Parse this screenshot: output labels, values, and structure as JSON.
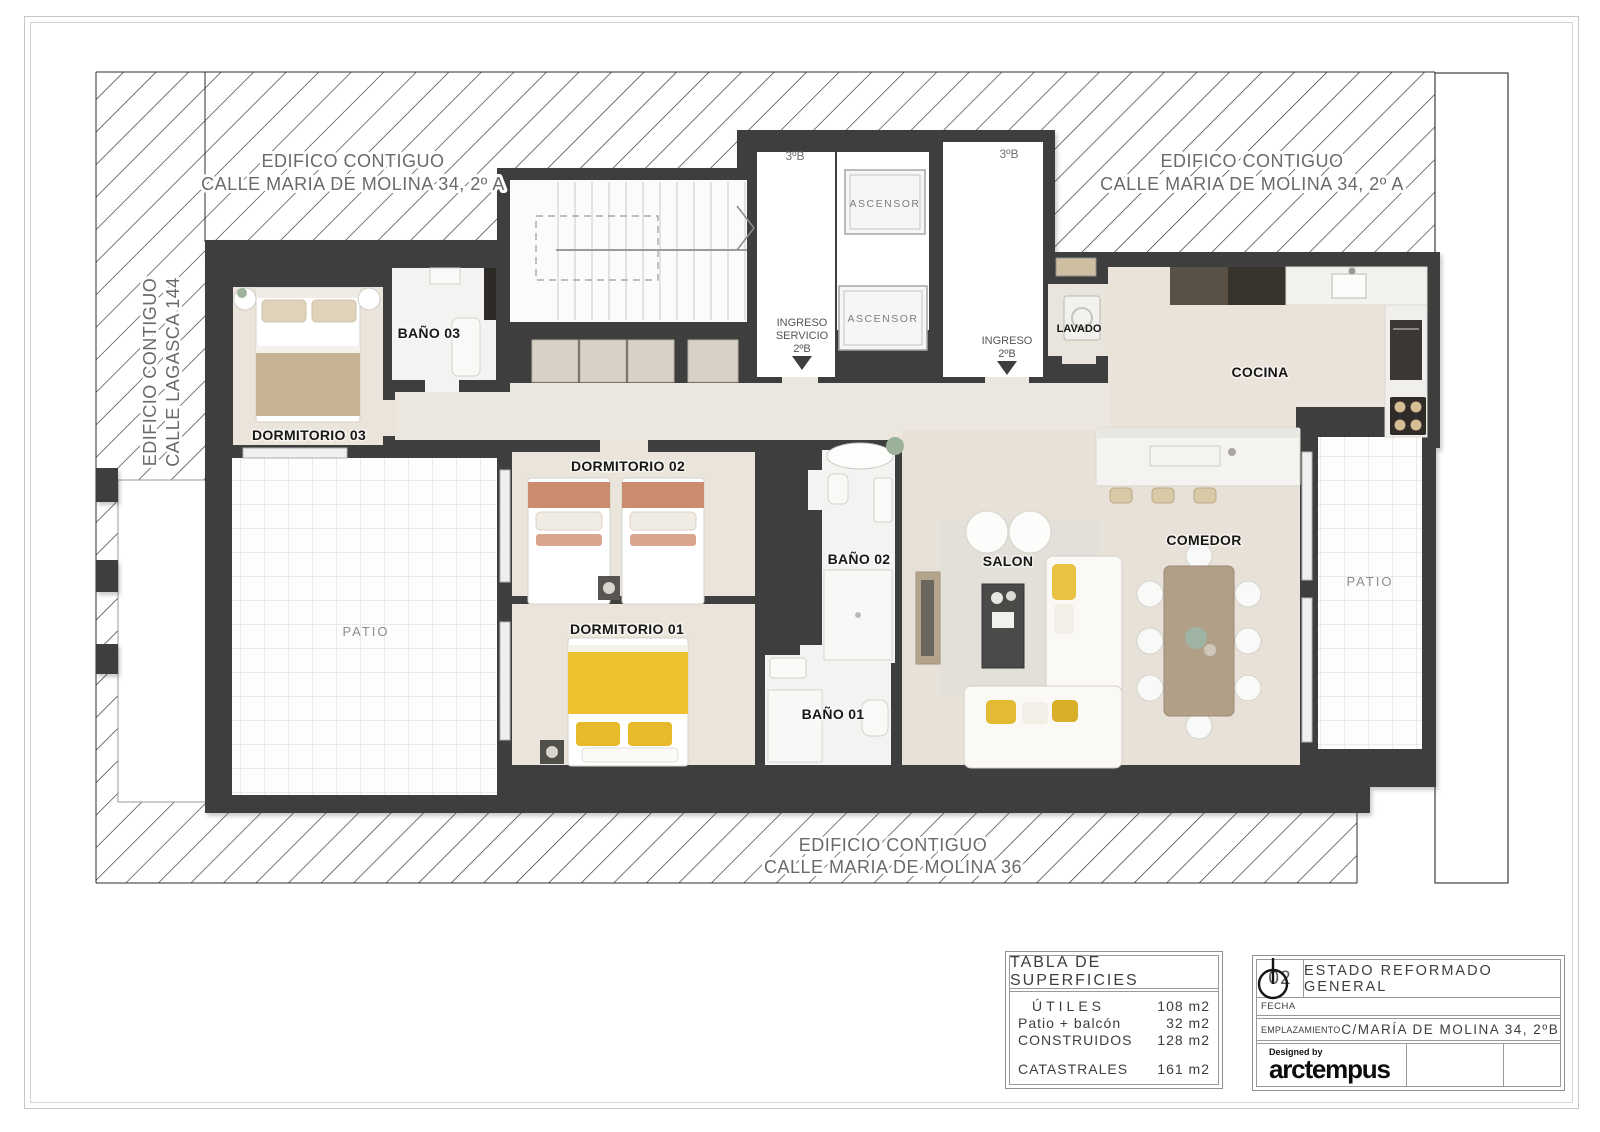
{
  "neighbors": {
    "top_left": {
      "line1": "EDIFICO CONTIGUO",
      "line2": "CALLE MARIA DE MOLINA 34, 2º A"
    },
    "top_right": {
      "line1": "EDIFICO CONTIGUO",
      "line2": "CALLE MARIA DE MOLINA 34, 2º A"
    },
    "left": {
      "line1": "EDIFICIO CONTIGUO",
      "line2": "CALLE LAGASCA 144"
    },
    "bottom": {
      "line1": "EDIFICIO CONTIGUO",
      "line2": "CALLE MARIA DE MOLINA 36"
    }
  },
  "rooms": {
    "dormitorio03": "DORMITORIO 03",
    "bano03": "BAÑO 03",
    "dormitorio02": "DORMITORIO 02",
    "dormitorio01": "DORMITORIO 01",
    "bano02": "BAÑO 02",
    "bano01": "BAÑO 01",
    "salon": "SALON",
    "comedor": "COMEDOR",
    "cocina": "COCINA",
    "lavado": "LAVADO",
    "patio_left": "PATIO",
    "patio_right": "PATIO"
  },
  "core": {
    "lobby_left_unit": "3ºB",
    "lobby_right_unit": "3ºB",
    "elevator1": "ASCENSOR",
    "elevator2": "ASCENSOR",
    "service_entry": {
      "line1": "INGRESO",
      "line2": "SERVICIO",
      "line3": "2ºB"
    },
    "main_entry": {
      "line1": "INGRESO",
      "line2": "2ºB"
    }
  },
  "surfaces_table": {
    "title": "TABLA DE SUPERFICIES",
    "rows": [
      {
        "label": "ÚTILES",
        "value": "108 m2"
      },
      {
        "label": "Patio + balcón",
        "value": "32 m2"
      },
      {
        "label": "CONSTRUIDOS",
        "value": "128 m2"
      },
      {
        "label": "CATASTRALES",
        "value": "161 m2"
      }
    ]
  },
  "title_block": {
    "sheet_number": "02",
    "sheet_title": "ESTADO REFORMADO GENERAL",
    "fecha_label": "FECHA",
    "fecha_value": "",
    "emplazamiento_label": "EMPLAZAMIENTO",
    "emplazamiento_value": "C/MARÍA DE MOLINA 34, 2ºB",
    "designed_by": "Designed by",
    "brand": "arctempus"
  },
  "colors": {
    "wall": "#3e3e3e",
    "wood_floor": "#e9e3da",
    "marble": "#f4f3f1",
    "accent_yellow": "#ecc12f",
    "accent_salmon": "#cc8a6f",
    "accent_beige": "#c8b294"
  }
}
